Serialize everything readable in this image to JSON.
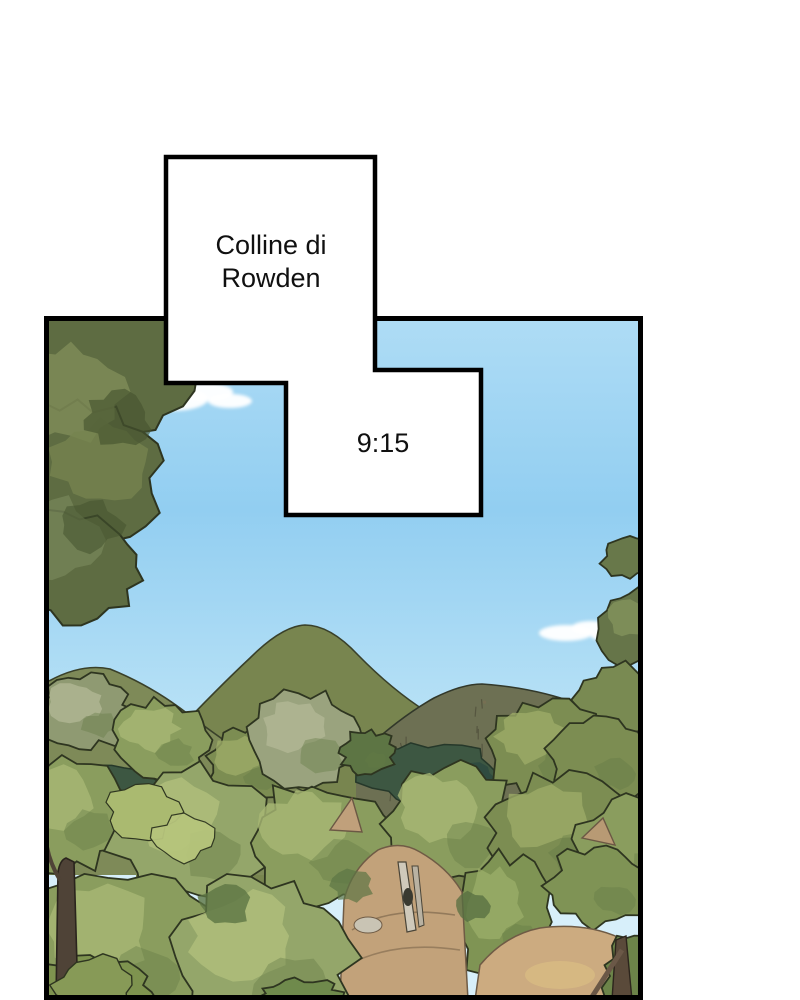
{
  "captions": {
    "location": "Colline di Rowden",
    "time": "9:15"
  },
  "scene_alt": "Illustrated landscape: green hills and dense tree canopy under a blue sky with small clouds",
  "artwork": {
    "colors": {
      "page_bg": "#ffffff",
      "panel_border": "#000000",
      "caption_bg": "#ffffff",
      "caption_border": "#000000",
      "caption_text": "#101010",
      "sky_top": "#aedcf5",
      "sky_mid": "#92cef1",
      "sky_lower": "#b9e2f6",
      "sky_horizon": "#d7effa",
      "cloud": "#ffffff",
      "hill_left": "#7e8a58",
      "hill_center": "#78854f",
      "hill_right": "#6d7053",
      "forest_shadow": "#3d5742",
      "forest_shadow_dark": "#2e4a40",
      "outline": "#2e3520",
      "dirt": "#c2a27a",
      "dirt_right": "#ccab80",
      "trunk_dark": "#4f4337",
      "trunk_light": "#cfc9ba"
    },
    "foliage": {
      "g1": "#7c8d52",
      "g2": "#8a9d5e",
      "g3": "#94a66a",
      "g4": "#a9ba73",
      "g5": "#5e6c42",
      "g6": "#6d8247",
      "gray": "#9aa37e"
    }
  }
}
